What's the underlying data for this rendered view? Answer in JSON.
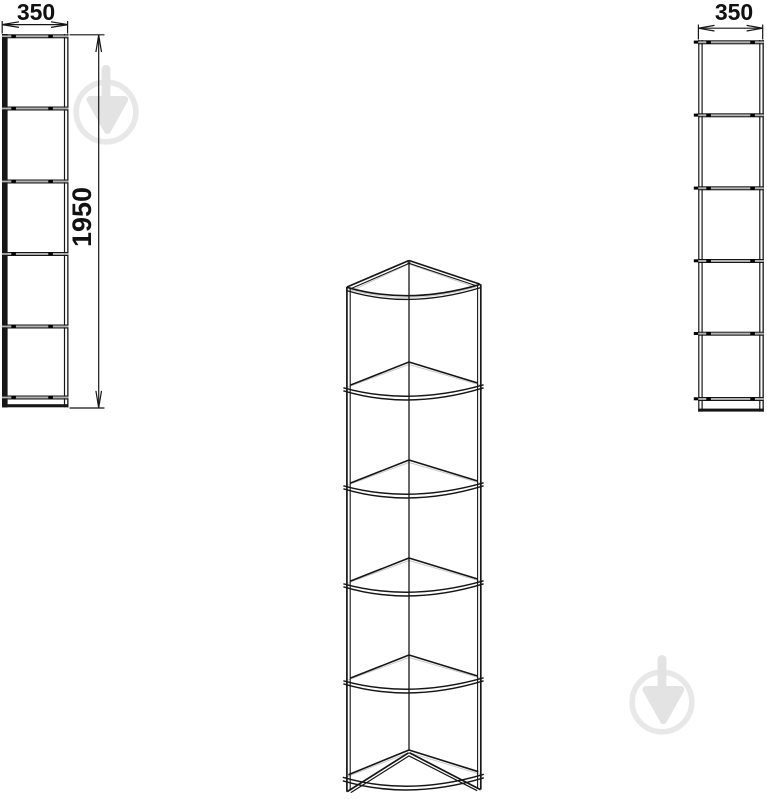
{
  "diagram": {
    "views": {
      "front_left": {
        "width_label": "350",
        "height_label": "1950",
        "compartments": 5
      },
      "perspective": {
        "shelf_levels": 6
      },
      "front_right": {
        "width_label": "350",
        "compartments": 5
      }
    },
    "colors": {
      "line": "#161616",
      "shelf_gap_fill": "#b2b2b2",
      "gray_accent": "#cbcbc7",
      "watermark_ring": "#e8e8e8",
      "watermark_glyph": "#e3e3e3",
      "background": "#ffffff"
    }
  },
  "icons": {
    "watermark": "trowel-in-circle-logo"
  }
}
